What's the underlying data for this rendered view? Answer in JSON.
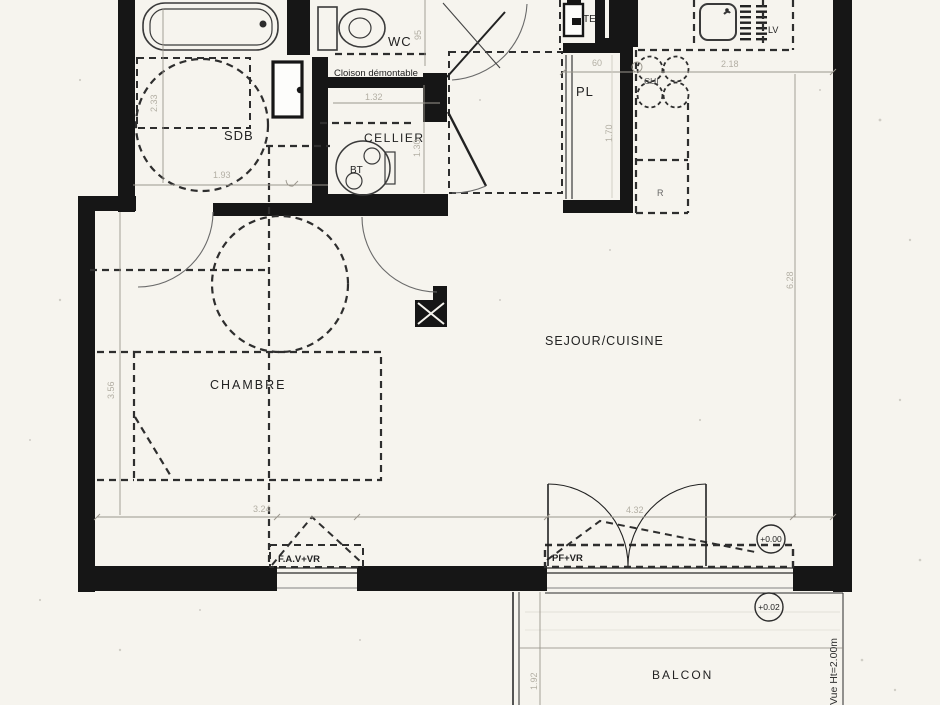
{
  "colors": {
    "paper": "#f6f4ee",
    "wall_ink": "#161616",
    "line_ink": "#3a3a3a",
    "dimension_gray": "#b3afa4",
    "label_ink": "#222222"
  },
  "plan": {
    "rooms": {
      "sdb": "SDB",
      "wc": "WC",
      "cellier": "CELLIER",
      "placard": "PL",
      "chambre": "CHAMBRE",
      "sejour_cuisine": "SEJOUR/CUISINE",
      "balcon": "BALCON"
    },
    "annotations": {
      "cloison_demontable": "Cloison démontable",
      "tableau_electrique": "TE",
      "ballon_thermo": "BT",
      "lave_vaisselle": "LV",
      "cuisson": "CUI",
      "refrigerateur": "R",
      "fenetre_chambre": "F.A.V+VR",
      "porte_fenetre_sejour": "PF+VR",
      "vue_note": "Vue Ht=2.00m"
    },
    "levels": {
      "sejour": "+0.00",
      "balcon": "+0.02"
    },
    "dimensions": {
      "sdb_width": "1.93",
      "sdb_depth": "2.33",
      "wc_depth": "95",
      "cellier_width": "1.32",
      "cellier_depth": "1.30",
      "placard_width": "60",
      "placard_depth": "1.70",
      "cuisine_width": "2.18",
      "sejour_depth": "6.28",
      "chambre_width": "3.24",
      "chambre_depth": "3.56",
      "sejour_width": "4.32",
      "balcon_depth": "1.92"
    }
  }
}
